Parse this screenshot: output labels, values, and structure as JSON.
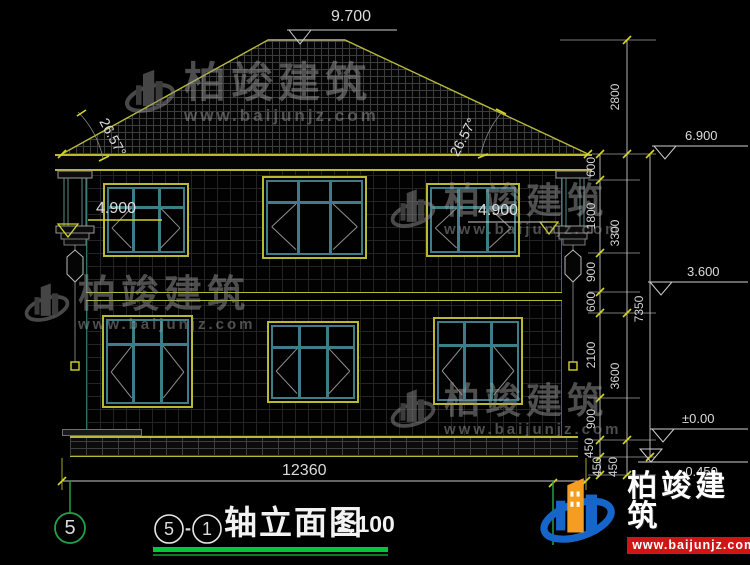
{
  "levels": {
    "ridge": "9.700",
    "eave": "6.900",
    "second": "3.600",
    "zero": "±0.00",
    "below": "-0.450"
  },
  "window_levels": {
    "left": "4.900",
    "right": "4.900"
  },
  "angles": {
    "left": "26.57°",
    "right": "26.57°"
  },
  "dimensions": {
    "inner": [
      "600",
      "1800",
      "900",
      "600",
      "2100",
      "900",
      "450",
      "450"
    ],
    "middle": [
      "2800",
      "3300",
      "3600",
      "450"
    ],
    "total_height": "7350",
    "total_width": "12360"
  },
  "axis": {
    "left_bubble": "5"
  },
  "title_block": {
    "axis_start": "5",
    "separator": "-",
    "axis_end": "1",
    "name": "轴立面图",
    "scale": "1:100"
  },
  "watermark": {
    "brand": "柏竣建筑",
    "url": "www.baijunjz.com"
  },
  "footer": {
    "brand": "柏竣建筑",
    "url": "www.baijunjz.com"
  },
  "colors": {
    "line_yellow": "#b9b932",
    "line_teal": "#3e7c88",
    "axis_green": "#21a246",
    "title_underline": "#00c838",
    "brand_blue": "#1566c8",
    "brand_orange": "#f59d20",
    "brand_red": "#d01515"
  }
}
